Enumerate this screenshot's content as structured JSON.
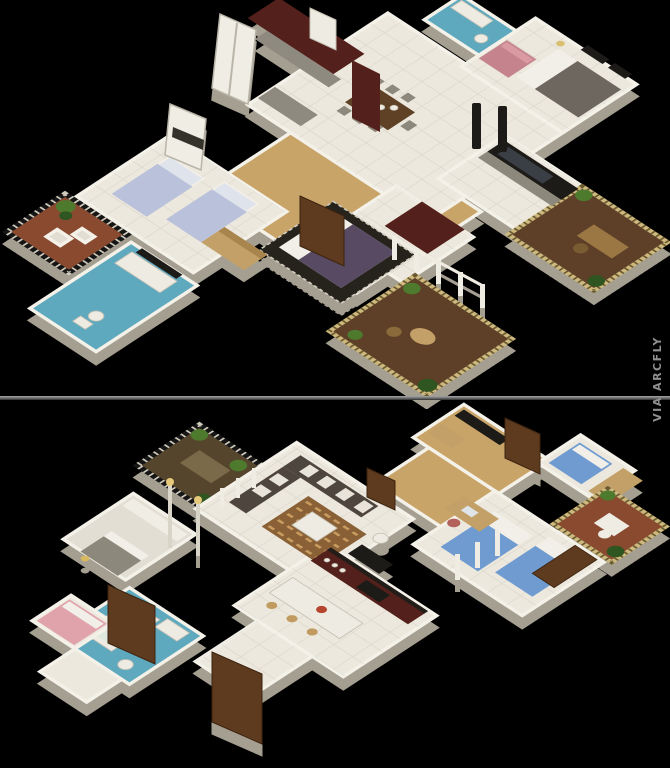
{
  "window": {
    "width": 670,
    "height": 768,
    "background": "#000000"
  },
  "watermark": {
    "text": "VIA ARCFLY",
    "color": "#8f8f8f",
    "orientation": "vertical"
  },
  "divider": {
    "color": "#6b6b6b"
  },
  "panels": {
    "top": {
      "label": "3D isometric apartment floor plan render (upper)"
    },
    "bottom": {
      "label": "3D isometric apartment floor plan render (lower)"
    }
  },
  "palette": {
    "background": "#000000",
    "floor_tile": "#ece8dd",
    "wall_white": "#f4f1e9",
    "wall_depth": "#a59f92",
    "wood_floor": "#c9a468",
    "mosaic_blue": "#5fa9bf",
    "cabinet_maroon": "#54201b",
    "deck_brown": "#5e3f28",
    "deck_terracotta": "#8a4a30",
    "lattice_gold": "#cdb97e",
    "lattice_dark": "#161616",
    "bed_purple": "#584a63",
    "bed_blue": "#6f9bd1",
    "bed_periwinkle": "#b9c2da",
    "sofa_pink": "#c5848d",
    "sofa_dark": "#4e463e",
    "plant_green": "#4e7a2e",
    "door_wood": "#5e3a1e"
  }
}
